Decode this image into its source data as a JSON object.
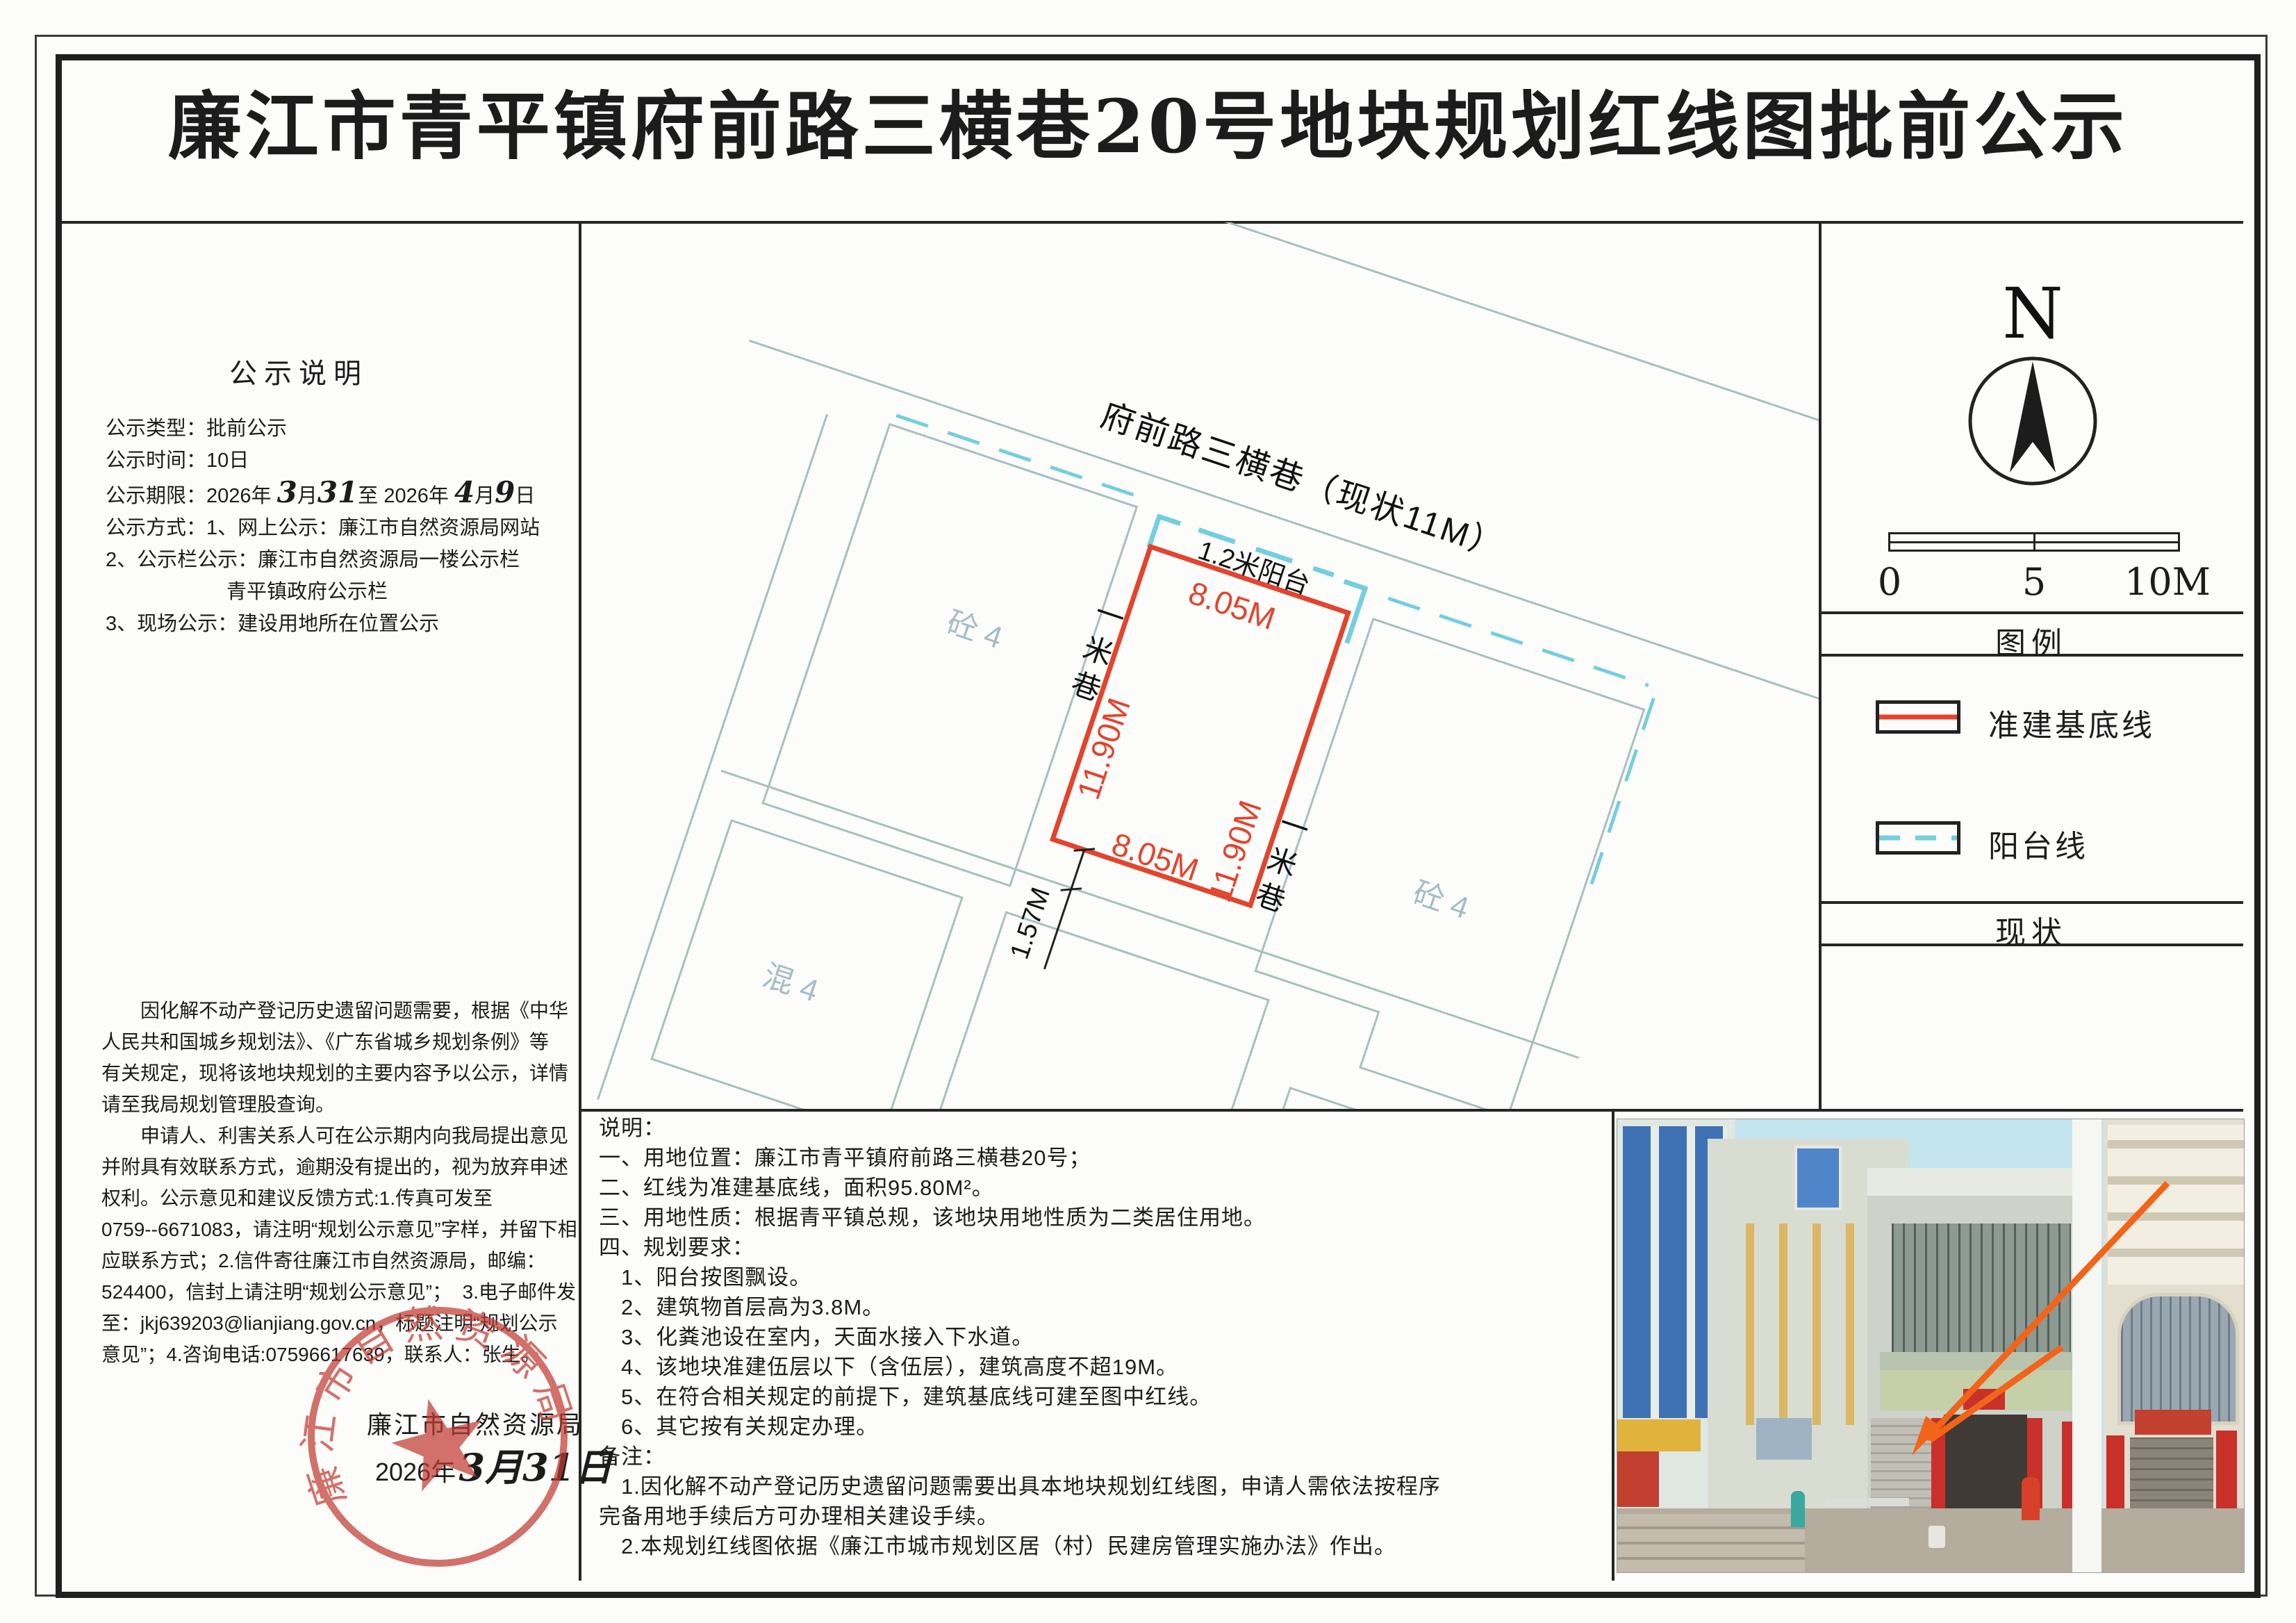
{
  "title": "廉江市青平镇府前路三横巷20号地块规划红线图批前公示",
  "left_panel": {
    "heading": "公示说明",
    "block1a": [
      "公示类型：批前公示",
      "公示时间：10日"
    ],
    "period": {
      "p0": "公示期限：2026年 ",
      "h1": "3",
      "p1": "月",
      "h2": "31",
      "p2": "至 2026年 ",
      "h3": "4",
      "p3": "月",
      "h4": "9",
      "p4": "日"
    },
    "block1b": [
      "公示方式：1、网上公示：廉江市自然资源局网站",
      "2、公示栏公示：廉江市自然资源局一楼公示栏",
      "　　　　　　青平镇政府公示栏",
      "3、现场公示：建设用地所在位置公示"
    ],
    "para": [
      "　　因化解不动产登记历史遗留问题需要，根据《中华",
      "人民共和国城乡规划法》、《广东省城乡规划条例》等",
      "有关规定，现将该地块规划的主要内容予以公示，详情",
      "请至我局规划管理股查询。",
      "　　申请人、利害关系人可在公示期内向我局提出意见",
      "并附具有效联系方式，逾期没有提出的，视为放弃申述",
      "权利。公示意见和建议反馈方式:1.传真可发至",
      "0759--6671083，请注明“规划公示意见”字样，并留下相",
      "应联系方式；2.信件寄往廉江市自然资源局，邮编：",
      "524400，信封上请注明“规划公示意见”；  3.电子邮件发",
      "至：jkj639203@lianjiang.gov.cn，标题注明“规划公示",
      "意见”；4.咨询电话:07596617639，联系人：张生。"
    ],
    "agency": "廉江市自然资源局",
    "date_printed": "2026年",
    "date_hand": "3月31日",
    "seal_text": "廉江市自然资源局"
  },
  "plan": {
    "road_label": "府前路三横巷（现状11M）",
    "balcony_label": "1.2米阳台",
    "dim_top": "8.05M",
    "dim_bottom": "8.05M",
    "dim_left": "11.90M",
    "dim_right": "11.90M",
    "dim_offset": "1.57M",
    "alley_chars": [
      "一",
      "米",
      "巷"
    ],
    "parcel_labels": [
      "砼 4",
      "砼 4",
      "混 4",
      "混 4"
    ]
  },
  "right_panel": {
    "north": "N",
    "scale_ticks": [
      "0",
      "5",
      "10M"
    ],
    "legend_heading": "图例",
    "legend": [
      {
        "label": "准建基底线"
      },
      {
        "label": "阳台线"
      }
    ],
    "status_heading": "现状"
  },
  "notes": {
    "lines": [
      "说明：",
      "一、用地位置：廉江市青平镇府前路三横巷20号；",
      "二、红线为准建基底线，面积95.80M²。",
      "三、用地性质：根据青平镇总规，该地块用地性质为二类居住用地。",
      "四、规划要求：",
      "　1、阳台按图飘设。",
      "　2、建筑物首层高为3.8M。",
      "　3、化粪池设在室内，天面水接入下水道。",
      "　4、该地块准建伍层以下（含伍层），建筑高度不超19M。",
      "　5、在符合相关规定的前提下，建筑基底线可建至图中红线。",
      "　6、其它按有关规定办理。",
      "备注：",
      "　1.因化解不动产登记历史遗留问题需要出具本地块规划红线图，申请人需依法按程序",
      "完备用地手续后方可办理相关建设手续。",
      "　2.本规划红线图依据《廉江市城市规划区居（村）民建房管理实施办法》作出。"
    ]
  },
  "colors": {
    "baseline_red": "#e2442e",
    "balcony_cyan": "#74cedd",
    "seal_red": "#c23b33",
    "arrow_orange": "#f26419",
    "parcel_text": "#a4bcc6",
    "street_line": "#a8bfc1",
    "ink": "#1c1c1c"
  }
}
